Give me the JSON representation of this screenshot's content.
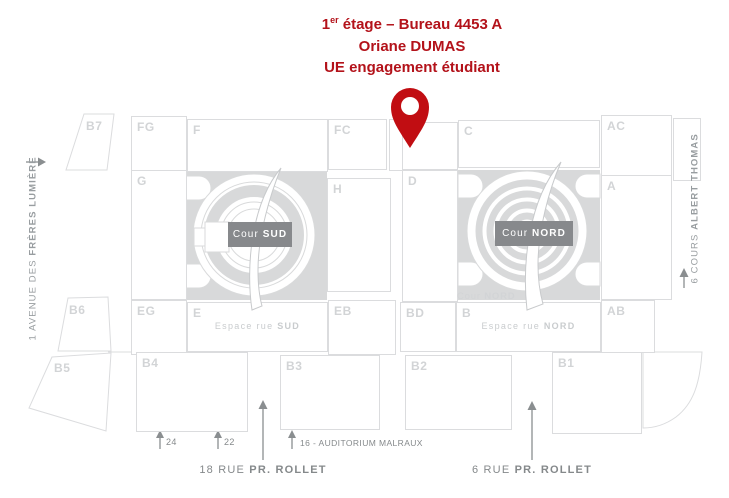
{
  "title": {
    "num": "1",
    "sup": "er",
    "line1_rest": " étage – Bureau 4453 A",
    "line2": "Oriane DUMAS",
    "line3": "UE engagement étudiant"
  },
  "map": {
    "blocks": {
      "b7": "B7",
      "fg": "FG",
      "f": "F",
      "fc": "FC",
      "c": "C",
      "ac": "AC",
      "g": "G",
      "h": "H",
      "d": "D",
      "a": "A",
      "b6": "B6",
      "eg": "EG",
      "e": "E",
      "eb": "EB",
      "bd": "BD",
      "b": "B",
      "ab": "AB",
      "b5": "B5",
      "b4": "B4",
      "b3": "B3",
      "b2": "B2",
      "b1": "B1"
    },
    "cour_sud": {
      "prefix": "Cour ",
      "bold": "SUD"
    },
    "cour_nord": {
      "prefix": "Cour ",
      "bold": "NORD"
    },
    "cour_nord_light": {
      "prefix": "Cour ",
      "bold": "NORD"
    },
    "espace_sud": {
      "prefix": "Espace rue ",
      "bold": "SUD"
    },
    "espace_nord": {
      "prefix": "Espace rue ",
      "bold": "NORD"
    }
  },
  "streets": {
    "avenue_left": {
      "prefix": "1 AVENUE DES ",
      "bold": "FRÈRES LUMIÈRE"
    },
    "cours_right": {
      "prefix": "6 COURS ",
      "bold": "ALBERT THOMAS"
    },
    "rue_18": {
      "prefix": "18 RUE ",
      "bold": "PR. ROLLET"
    },
    "rue_6": {
      "prefix": "6 RUE ",
      "bold": "PR. ROLLET"
    }
  },
  "annotations": {
    "n24": "24",
    "n22": "22",
    "auditorium": "16 - AUDITORIUM MALRAUX"
  },
  "colors": {
    "accent_red": "#b3121a",
    "pin_red": "#c10d12",
    "outline_gray": "#dbdcde",
    "fill_gray": "#d8d9da",
    "label_gray": "#d2d4d6",
    "street_gray": "#85898b",
    "badge_gray": "#87898c"
  }
}
